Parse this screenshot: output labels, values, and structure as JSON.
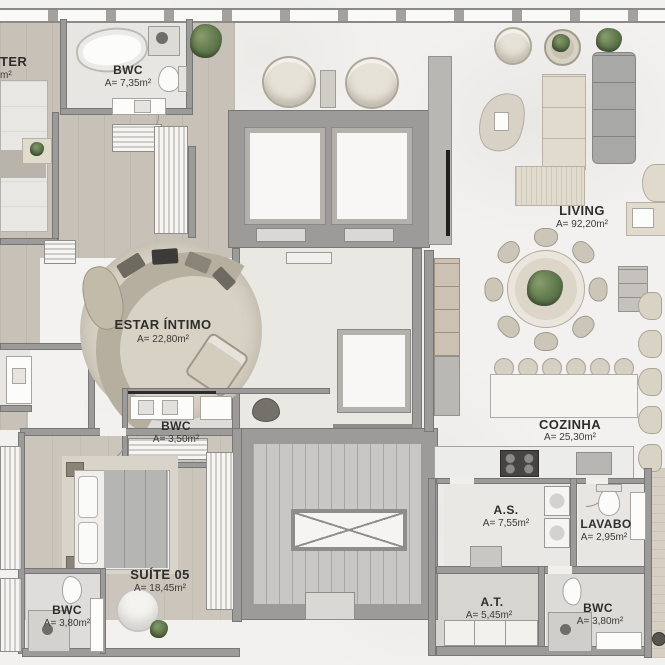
{
  "rooms": [
    {
      "id": "master",
      "label": "TER",
      "area": "m²"
    },
    {
      "id": "bwc-master",
      "label": "BWC",
      "area": "A= 7,35m²"
    },
    {
      "id": "living",
      "label": "LIVING",
      "area": "A= 92,20m²"
    },
    {
      "id": "estar-intimo",
      "label": "ESTAR ÍNTIMO",
      "area": "A= 22,80m²"
    },
    {
      "id": "bwc-intimo",
      "label": "BWC",
      "area": "A= 3,50m²"
    },
    {
      "id": "cozinha",
      "label": "COZINHA",
      "area": "A= 25,30m²"
    },
    {
      "id": "suite-05",
      "label": "SUÍTE 05",
      "area": "A= 18,45m²"
    },
    {
      "id": "bwc-suite",
      "label": "BWC",
      "area": "A= 3,80m²"
    },
    {
      "id": "as",
      "label": "A.S.",
      "area": "A= 7,55m²"
    },
    {
      "id": "lavabo",
      "label": "LAVABO",
      "area": "A= 2,95m²"
    },
    {
      "id": "at",
      "label": "A.T.",
      "area": "A= 5,45m²"
    },
    {
      "id": "bwc-service",
      "label": "BWC",
      "area": "A= 3,80m²"
    }
  ],
  "colors": {
    "marble_floor": "#f2f1ef",
    "wood_floor": "#c8c1b7",
    "wall": "#9c9b99",
    "hall_floor": "#e9e8e2",
    "stair_floor": "#c8c7c5",
    "plant_green": "#5b7349",
    "label_text": "#2e2e2c"
  }
}
